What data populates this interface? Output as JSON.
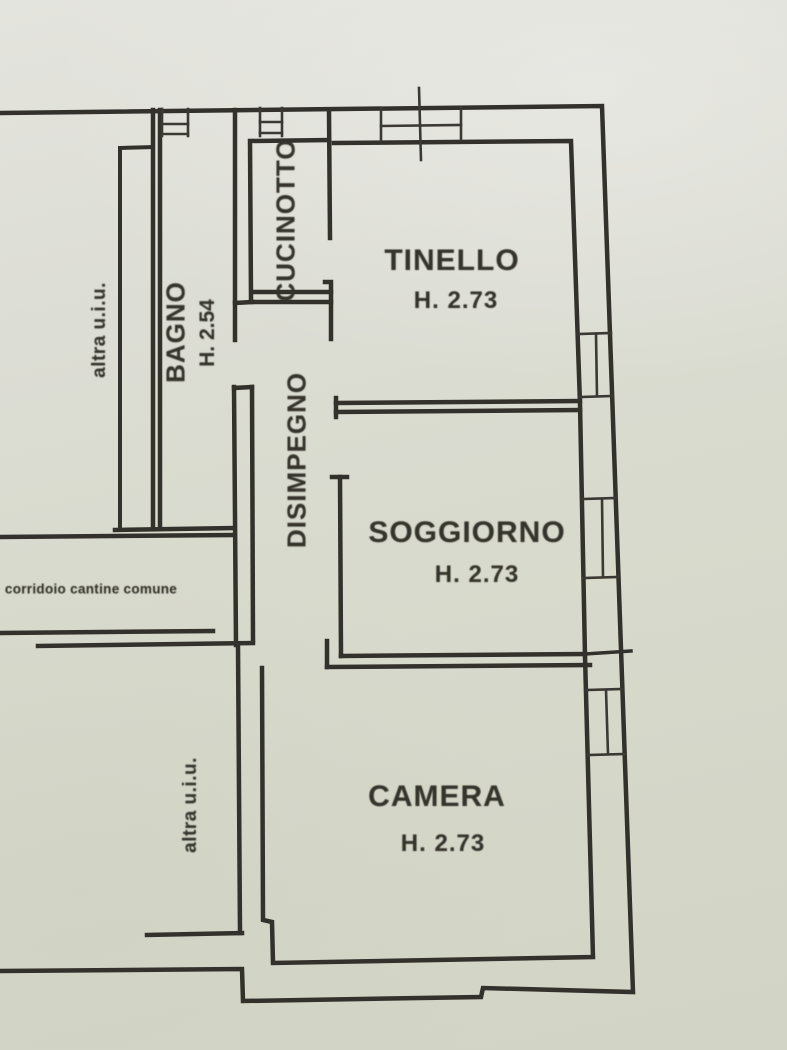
{
  "plan": {
    "rooms": [
      {
        "name": "CUCINOTTO",
        "height": ""
      },
      {
        "name": "TINELLO",
        "height": "H. 2.73"
      },
      {
        "name": "BAGNO",
        "height": "H. 2.54"
      },
      {
        "name": "DISIMPEGNO",
        "height": ""
      },
      {
        "name": "SOGGIORNO",
        "height": "H. 2.73"
      },
      {
        "name": "CAMERA",
        "height": "H. 2.73"
      }
    ],
    "external_areas": [
      {
        "name": "altra u.i.u."
      },
      {
        "name": "corridoio cantine comune"
      },
      {
        "name": "altra u.i.u."
      }
    ],
    "colors": {
      "paper": "#d8dacd",
      "ink": "#32312b"
    }
  }
}
